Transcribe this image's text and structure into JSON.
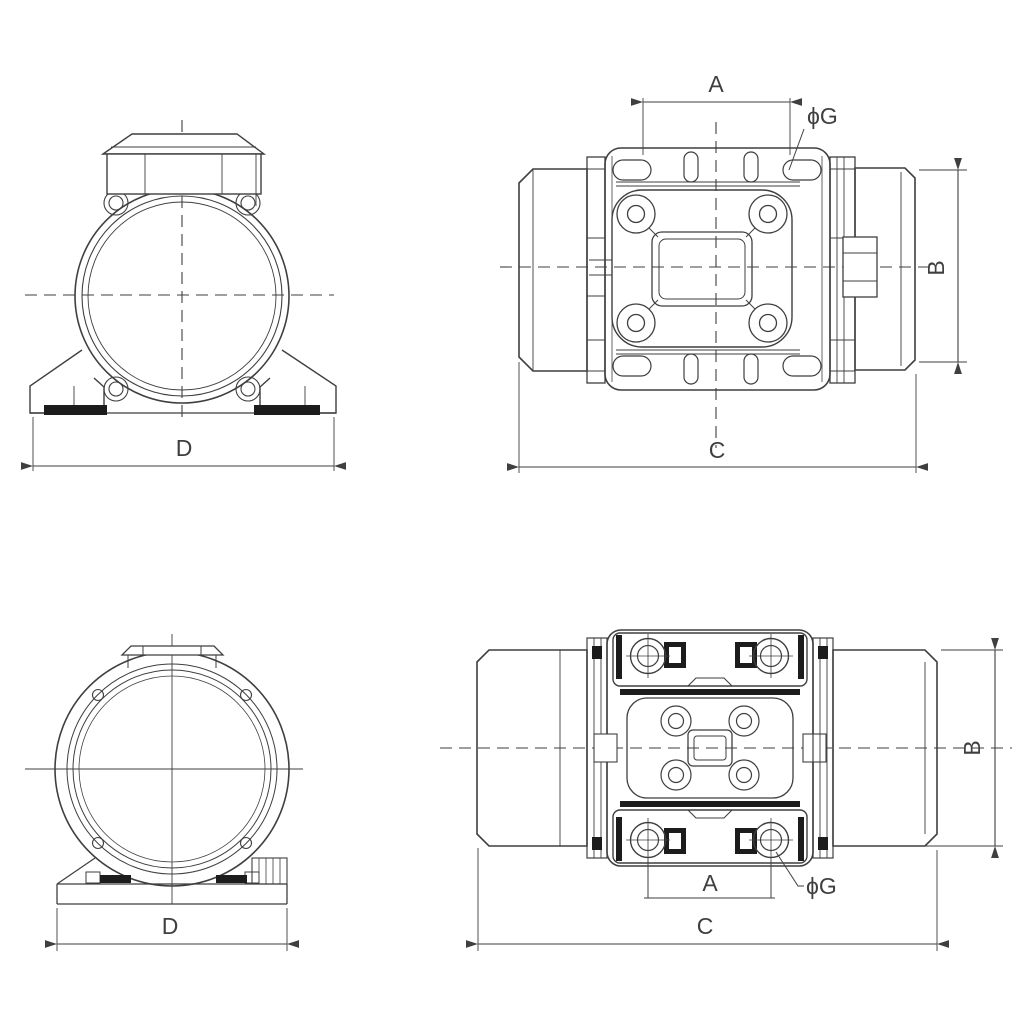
{
  "drawing": {
    "type": "technical-dimension-drawing",
    "subject": "vibration-motor-four-view-outline-drawing",
    "colors": {
      "line": "#3f3f3f",
      "solid_fill": "#1c1c1c",
      "background": "#ffffff"
    }
  },
  "views": {
    "front": {
      "dim_d": "D"
    },
    "top": {
      "dim_a": "A",
      "dim_b": "B",
      "dim_c": "C",
      "dim_phi_g": "ϕG"
    },
    "rear": {
      "dim_d": "D"
    },
    "bottom": {
      "dim_a": "A",
      "dim_b": "B",
      "dim_c": "C",
      "dim_phi_g": "ϕG"
    }
  }
}
